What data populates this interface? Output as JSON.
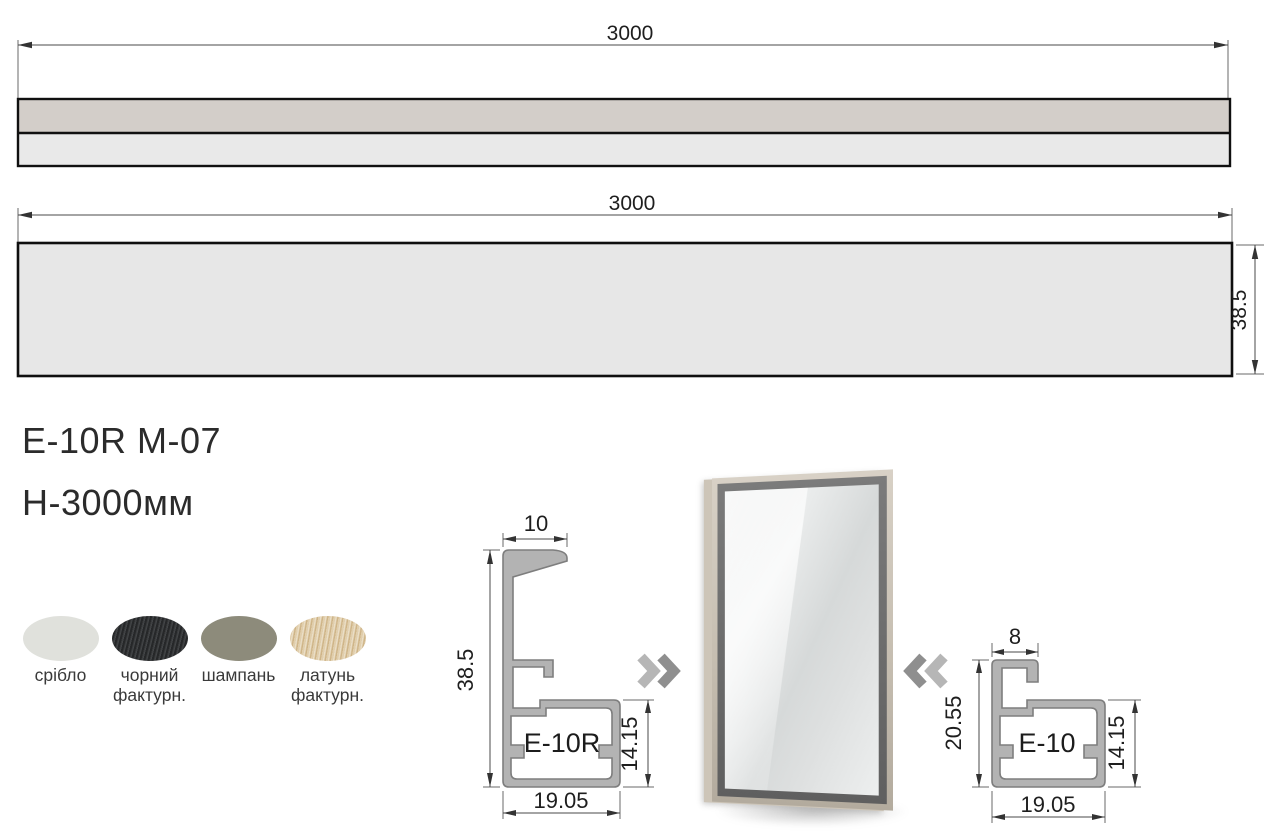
{
  "drawing": {
    "top_bar": {
      "length_label": "3000"
    },
    "bottom_bar": {
      "length_label": "3000",
      "height_label": "38.5"
    }
  },
  "product": {
    "code": "E-10R M-07",
    "height": "H-3000мм"
  },
  "finishes": [
    {
      "name": "срібло",
      "color": "#e0e1dc"
    },
    {
      "name": "чорний фактурн.",
      "color": "#2e3032"
    },
    {
      "name": "шампань",
      "color": "#8d8b7b"
    },
    {
      "name": "латунь фактурн.",
      "color": "#d9c298"
    }
  ],
  "profile_left": {
    "label": "E-10R",
    "top_width": "10",
    "height": "38.5",
    "box_height": "14.15",
    "width": "19.05"
  },
  "profile_right": {
    "label": "E-10",
    "top_width": "8",
    "height": "20.55",
    "box_height": "14.15",
    "width": "19.05"
  }
}
